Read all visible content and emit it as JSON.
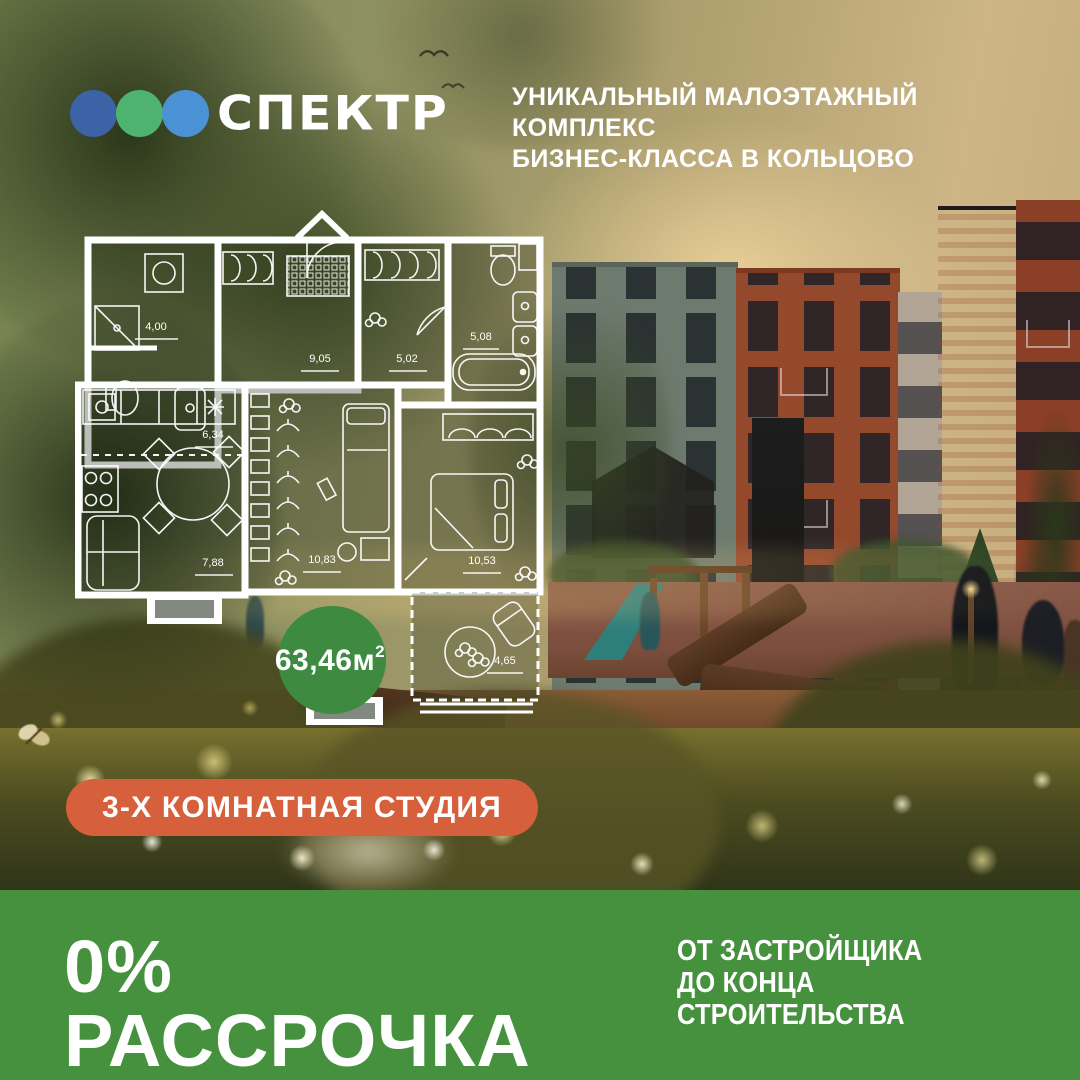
{
  "brand": {
    "name": "СПЕКТР",
    "logo_dots": [
      "#3b63a5",
      "#4db36e",
      "#4b92d5"
    ],
    "tagline_line1": "УНИКАЛЬНЫЙ МАЛОЭТАЖНЫЙ КОМПЛЕКС",
    "tagline_line2": "БИЗНЕС-КЛАССА В КОЛЬЦОВО"
  },
  "floor_plan": {
    "total_area": "63,46м",
    "total_area_sup": "2",
    "area_circle_color": "#3d8a40",
    "rooms": [
      {
        "name": "bathroom-small",
        "area": "4,00"
      },
      {
        "name": "hallway",
        "area": "9,05"
      },
      {
        "name": "wardrobe-room",
        "area": "5,02"
      },
      {
        "name": "bathroom-main",
        "area": "5,08"
      },
      {
        "name": "kitchen",
        "area": "6,34"
      },
      {
        "name": "living-room",
        "area": "7,88"
      },
      {
        "name": "room-middle",
        "area": "10,83"
      },
      {
        "name": "bedroom",
        "area": "10,53"
      },
      {
        "name": "balcony",
        "area": "4,65"
      }
    ]
  },
  "badge": {
    "label": "3-Х КОМНАТНАЯ СТУДИЯ",
    "color": "#d5603b"
  },
  "footer": {
    "headline": "0% РАССРОЧКА",
    "sub_line1": "ОТ ЗАСТРОЙЩИКА",
    "sub_line2": "ДО КОНЦА СТРОИТЕЛЬСТВА",
    "background": "#45913e"
  }
}
